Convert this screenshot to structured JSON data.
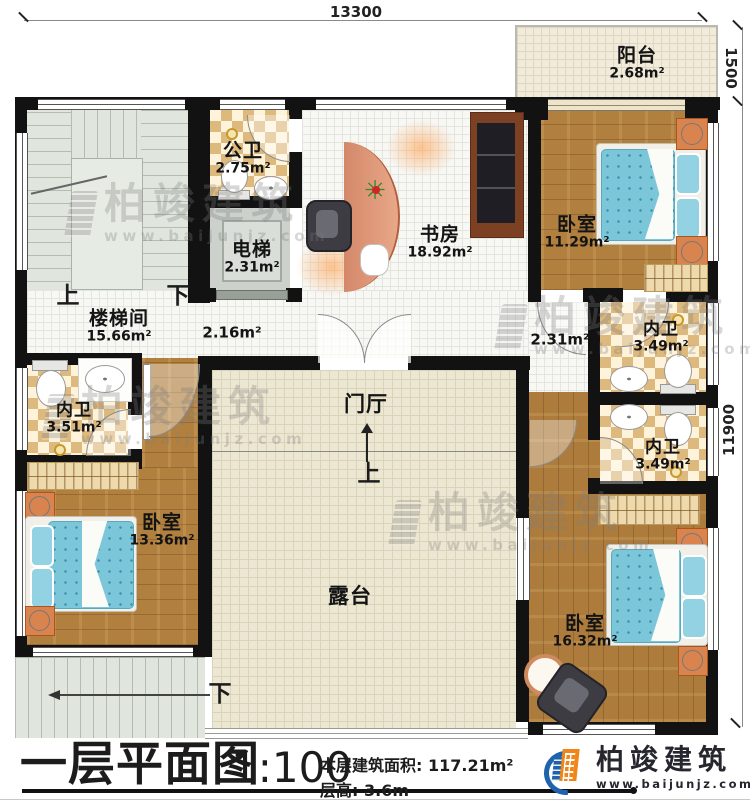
{
  "dimensions": {
    "width": "13300",
    "balcony_depth": "1500",
    "height": "11900"
  },
  "rooms": {
    "balcony": {
      "name": "阳台",
      "area": "2.68m²"
    },
    "public_bath": {
      "name": "公卫",
      "area": "2.75m²"
    },
    "elevator": {
      "name": "电梯",
      "area": "2.31m²"
    },
    "study": {
      "name": "书房",
      "area": "18.92m²"
    },
    "bedroom_ne": {
      "name": "卧室",
      "area": "11.29m²"
    },
    "stair_hall": {
      "name": "楼梯间",
      "area": "15.66m²"
    },
    "hall_west": {
      "area": "2.16m²"
    },
    "hall_east": {
      "area": "2.31m²"
    },
    "bath_ne": {
      "name": "内卫",
      "area": "3.49m²"
    },
    "bath_se": {
      "name": "内卫",
      "area": "3.49m²"
    },
    "bath_sw": {
      "name": "内卫",
      "area": "3.51m²"
    },
    "bedroom_sw": {
      "name": "卧室",
      "area": "13.36m²"
    },
    "bedroom_se": {
      "name": "卧室",
      "area": "16.32m²"
    },
    "foyer": {
      "name": "门厅"
    },
    "terrace": {
      "name": "露台"
    }
  },
  "stairs": {
    "up": "上",
    "down": "下"
  },
  "entry": {
    "up": "上"
  },
  "title_block": {
    "title": "一层平面图",
    "scale": "1:100",
    "area_label": "本层建筑面积:",
    "area_value": "117.21m²",
    "height_label": "层高:",
    "height_value": "3.6m"
  },
  "brand": {
    "name": "柏竣建筑",
    "url": "www.baijunjz.com"
  },
  "watermark": {
    "name": "柏竣建筑",
    "url": "www.baijunjz.com"
  },
  "colors": {
    "wall": "#121212",
    "wood": "#b1803f",
    "checker": "#e9c98d",
    "mattress": "#7cc6da",
    "brand_blue": "#1f63ad",
    "brand_orange": "#f08519"
  }
}
